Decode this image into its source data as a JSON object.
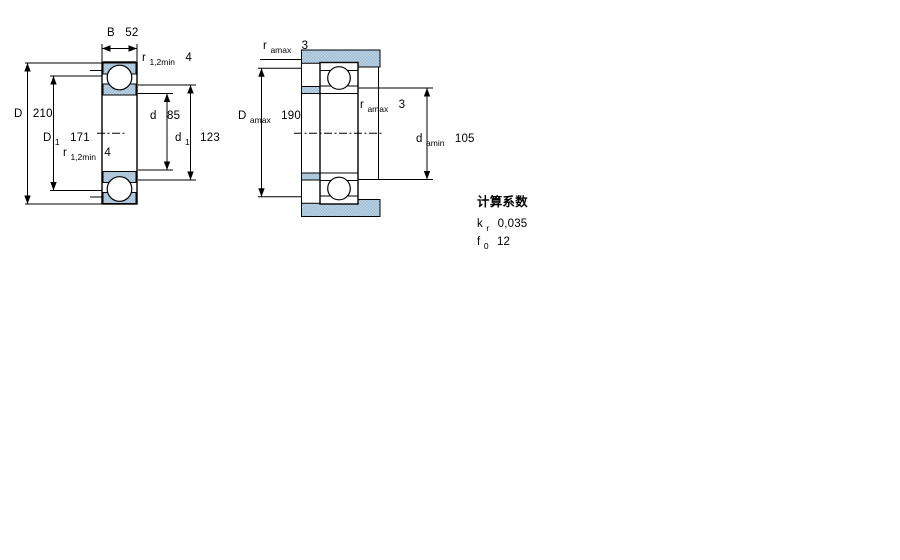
{
  "left_view": {
    "b": {
      "symbol": "B",
      "value": "52"
    },
    "r_top": {
      "symbol": "r",
      "sub": "1,2min",
      "value": "4"
    },
    "D": {
      "symbol": "D",
      "value": "210"
    },
    "D1": {
      "symbol": "D",
      "sub": "1",
      "value": "171"
    },
    "r_bottom": {
      "symbol": "r",
      "sub": "1,2min",
      "value": "4"
    },
    "d": {
      "symbol": "d",
      "value": "85"
    },
    "d1": {
      "symbol": "d",
      "sub": "1",
      "value": "123"
    }
  },
  "right_view": {
    "r_amax_top": {
      "symbol": "r",
      "sub": "amax",
      "value": "3"
    },
    "Da_max": {
      "symbol": "D",
      "sub": "amax",
      "value": "190"
    },
    "r_amax_mid": {
      "symbol": "r",
      "sub": "amax",
      "value": "3"
    },
    "da_min": {
      "symbol": "d",
      "sub": "amin",
      "value": "105"
    }
  },
  "calculation_factors": {
    "heading": "计算系数",
    "k_r": {
      "symbol": "k",
      "sub": "r",
      "value": "0,035"
    },
    "f_0": {
      "symbol": "f",
      "sub": "0",
      "value": "12"
    }
  },
  "colors": {
    "section_fill_light": "#c2d7e5",
    "section_fill_dark": "#9bb9d2",
    "line": "#000000"
  }
}
